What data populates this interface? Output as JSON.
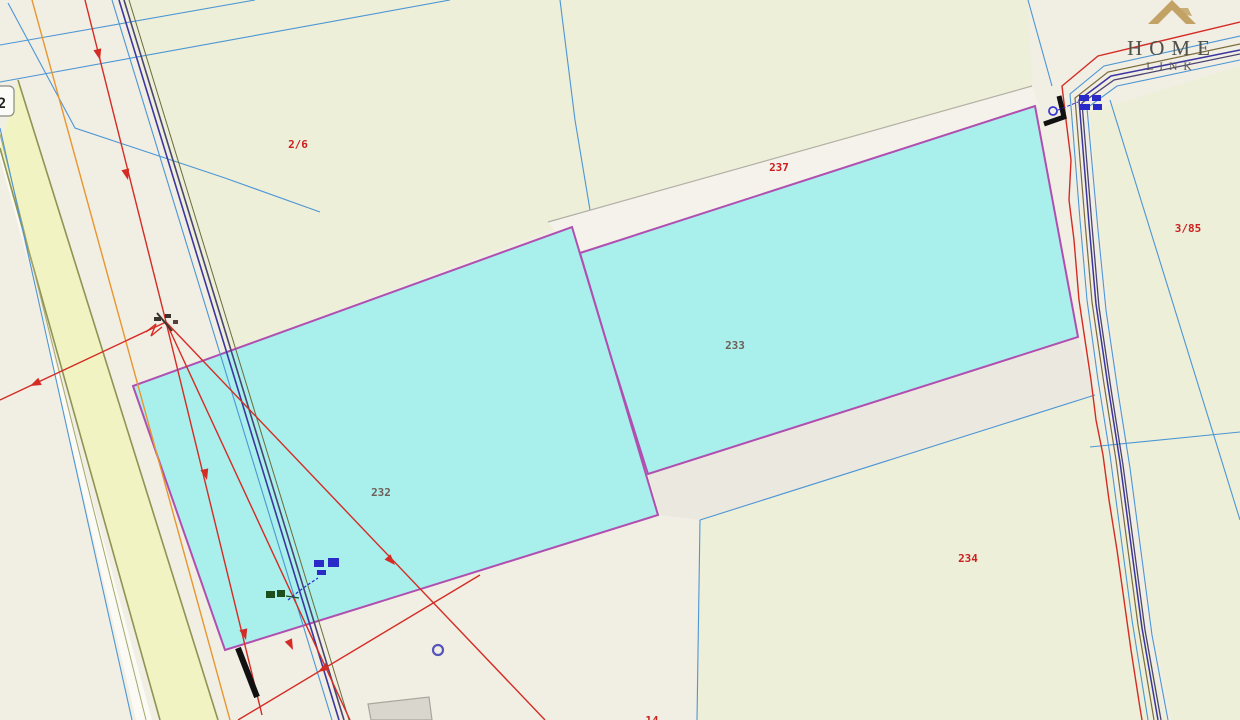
{
  "map": {
    "parcels": {
      "p26": {
        "label": "2/6"
      },
      "p237": {
        "label": "237"
      },
      "p233": {
        "label": "233"
      },
      "p232": {
        "label": "232"
      },
      "p234": {
        "label": "234"
      },
      "p385": {
        "label": "3/85"
      },
      "p14": {
        "label": "14"
      }
    },
    "road_badge": "2",
    "colors": {
      "background": "#f1eee4",
      "parcel_green": "#edefd9",
      "highlight_cyan": "#a9efec",
      "strip_white": "#f4f2ea",
      "gray_area": "#ebe8e0",
      "road_yellow": "#f2f3c3",
      "boundary_magenta": "#b04fb0",
      "cadastral_blue": "#4d96d4",
      "utility_red": "#d42c24",
      "utility_orange": "#e8962e",
      "utility_indigo": "#3b35a0",
      "olive": "#8f9453",
      "label_red": "#cc2020",
      "label_dark": "#6e6058",
      "logo_gold": "#c2a265"
    }
  },
  "logo": {
    "line1": "HOME",
    "line2": "LINK"
  }
}
